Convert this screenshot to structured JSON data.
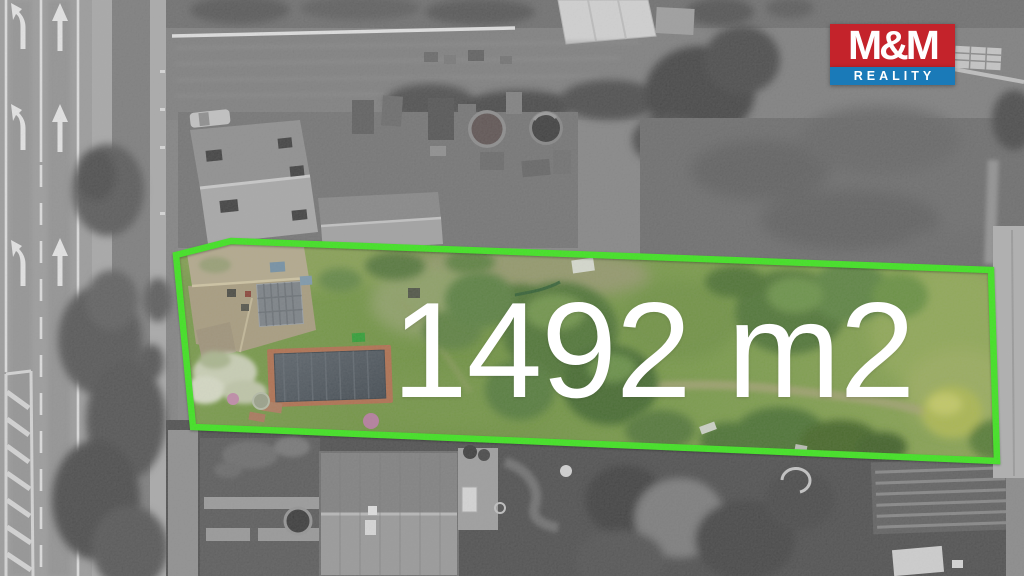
{
  "overlay": {
    "area_label": "1492 m2",
    "label_color": "#ffffff"
  },
  "logo": {
    "name": "M&M",
    "subtitle": "REALITY",
    "name_bg": "#c4232b",
    "subtitle_bg": "#1a7ab8",
    "text_color": "#ffffff"
  },
  "boundary": {
    "color": "#3ce51c",
    "points": "176,255 231,241 991,270 997,461 193,427"
  }
}
